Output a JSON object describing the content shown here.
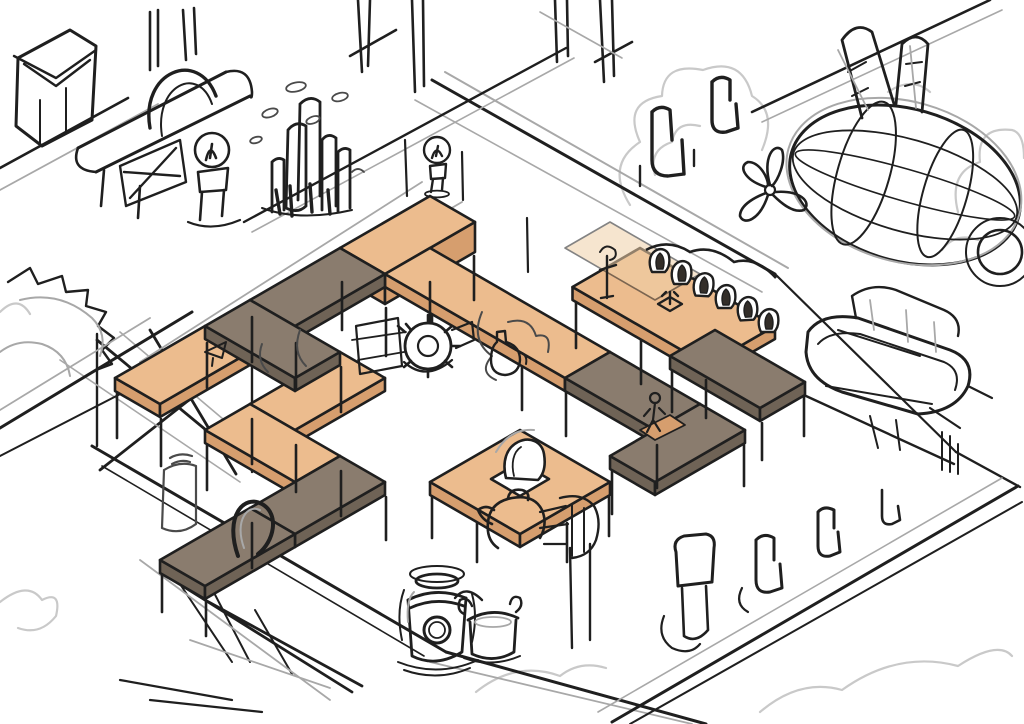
{
  "palette": {
    "paper": "#ffffff",
    "ink": "#1f1f1f",
    "ink_soft": "#4a4a4a",
    "pencil": "#a8a8a8",
    "cloud": "#c9c9c9",
    "tan_top": "#ecbc8e",
    "tan_tint": "#f0d0a8",
    "tan_side": "#d69e6e",
    "dark_top": "#8a7c6e",
    "dark_side": "#6f6356",
    "figure_shadow": "#332e29"
  },
  "scene": {
    "type": "isometric-game-level-concept-sketch",
    "medium": "digital pencil sketch with flat color blockout",
    "objects": [
      {
        "id": "maze-walkways",
        "label": "elevated zig-zag walkways on stilts"
      },
      {
        "id": "airship",
        "label": "airship with balloon, fins, propeller and boat gondola"
      },
      {
        "id": "boiler-machine",
        "label": "steam boiler machine"
      },
      {
        "id": "chimney-cluster",
        "label": "cluster of chimney pipes"
      },
      {
        "id": "bulb-lamps",
        "label": "bulb lamps"
      },
      {
        "id": "queue-figures",
        "label": "queue of hooded figures waiting on platform"
      },
      {
        "id": "hole-figure",
        "label": "figure climbing out of hatch platform"
      },
      {
        "id": "gear-machine",
        "label": "gear saw machine"
      },
      {
        "id": "barrel-and-pot",
        "label": "boiler barrel and pot"
      },
      {
        "id": "deck-edges",
        "label": "floating deck edges, ramp and braces"
      },
      {
        "id": "gear-relief",
        "label": "cog wheel at left edge"
      },
      {
        "id": "clouds",
        "label": "sketched clouds"
      }
    ],
    "counts": {
      "queue_figures": 6,
      "chimneys": 5,
      "walkway_colors": 2
    }
  }
}
